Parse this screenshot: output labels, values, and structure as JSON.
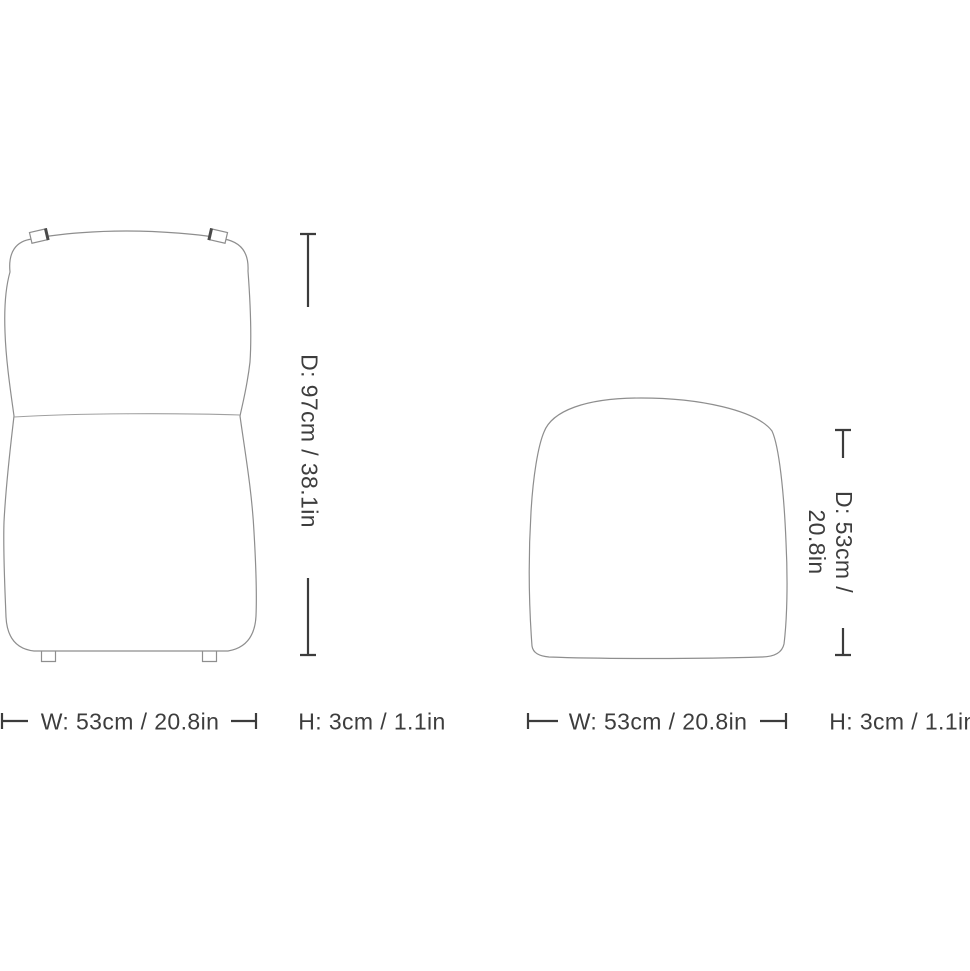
{
  "diagram": {
    "back_cushion": {
      "depth_label": "D: 97cm / 38.1in",
      "width_label": "W: 53cm / 20.8in",
      "height_label": "H: 3cm / 1.1in"
    },
    "seat_cushion": {
      "depth_label_line1": "D: 53cm /",
      "depth_label_line2": "20.8in",
      "width_label": "W: 53cm / 20.8in",
      "height_label": "H: 3cm / 1.1in"
    },
    "colors": {
      "outline": "#8e8e8e",
      "seam": "#a0a0a0",
      "strap_accent": "#4a4a4a",
      "dimension": "#3c3c3c",
      "text": "#3d3d3d",
      "background": "#ffffff"
    }
  }
}
